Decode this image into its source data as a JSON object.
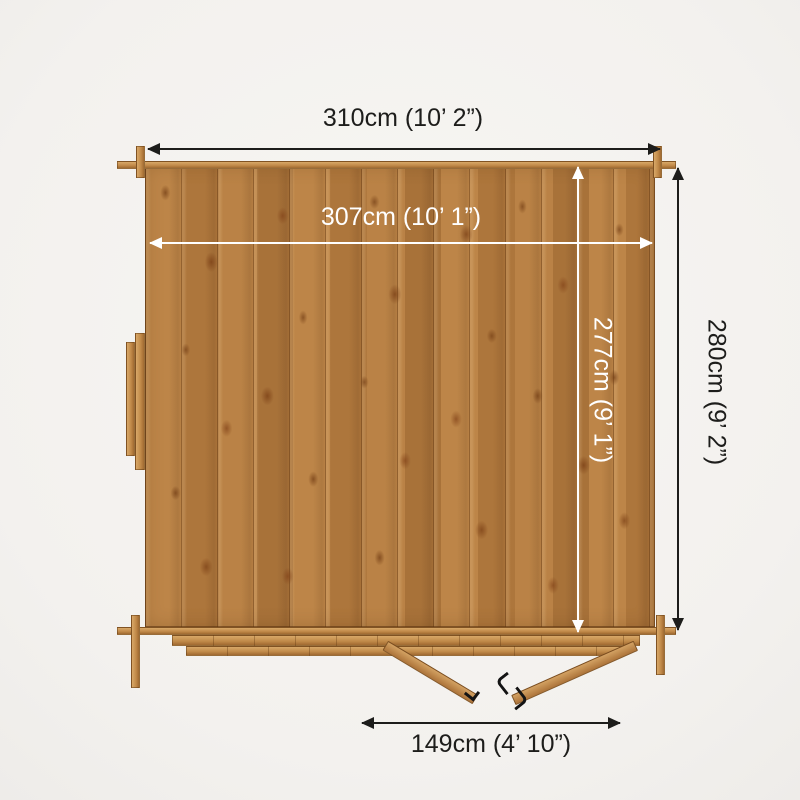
{
  "diagram": {
    "dimensions": {
      "external_width": "310cm (10’ 2”)",
      "internal_width": "307cm (10’ 1”)",
      "internal_depth": "277cm (9’ 1”)",
      "external_depth": "280cm (9’ 2”)",
      "door_opening_width": "149cm (4’ 10”)"
    },
    "colors": {
      "background": "#f4f2ef",
      "wood_base": "#b67d40",
      "wood_light": "#cf9b5e",
      "annotation_dark": "#1d1d1b",
      "annotation_light": "#ffffff"
    }
  }
}
